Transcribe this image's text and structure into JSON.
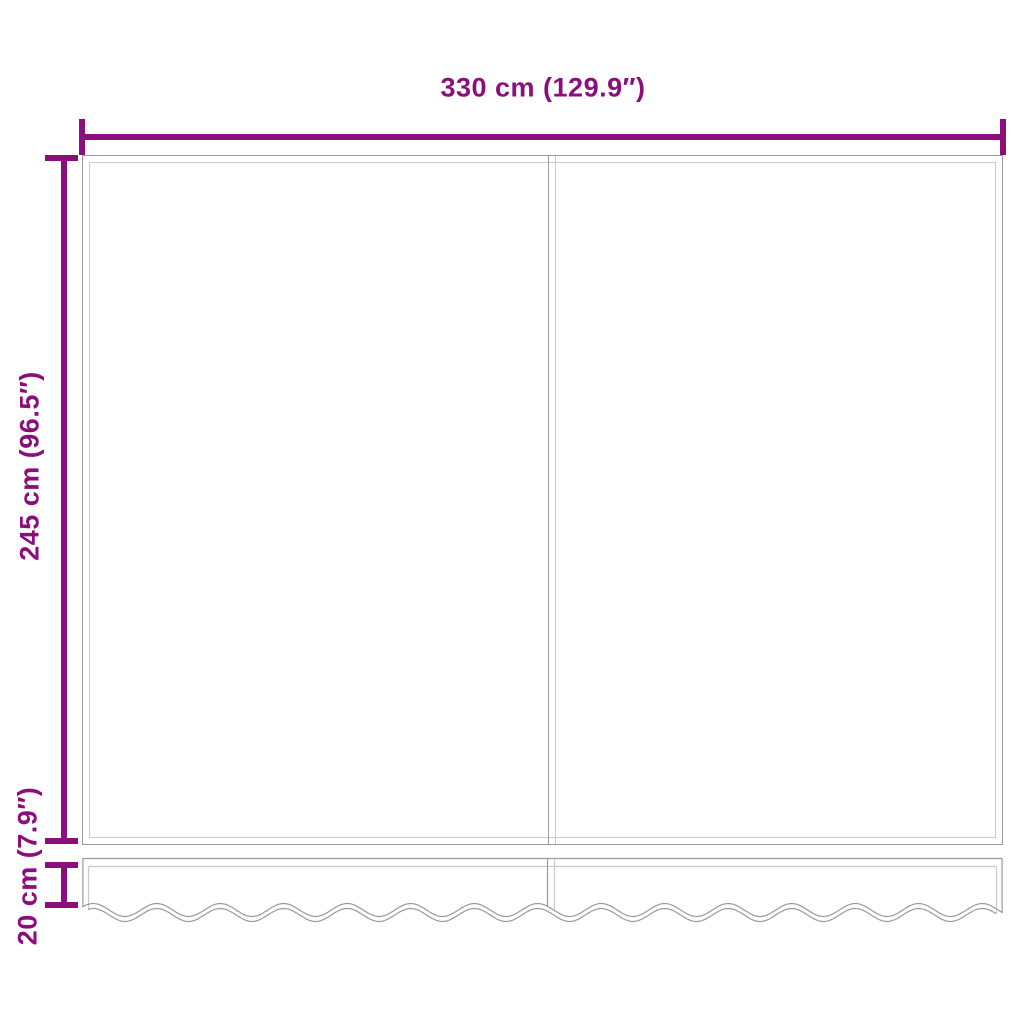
{
  "diagram": {
    "kind": "awning-fabric-dimension-diagram",
    "dimensions": {
      "width_label": "330 cm (129.9″)",
      "height_label": "245 cm (96.5″)",
      "valance_height_label": "20 cm (7.9″)"
    },
    "colors": {
      "dimension": "#8B0E7C",
      "outline": "#9A9A9A",
      "outline-light": "#C9C9C9"
    }
  }
}
